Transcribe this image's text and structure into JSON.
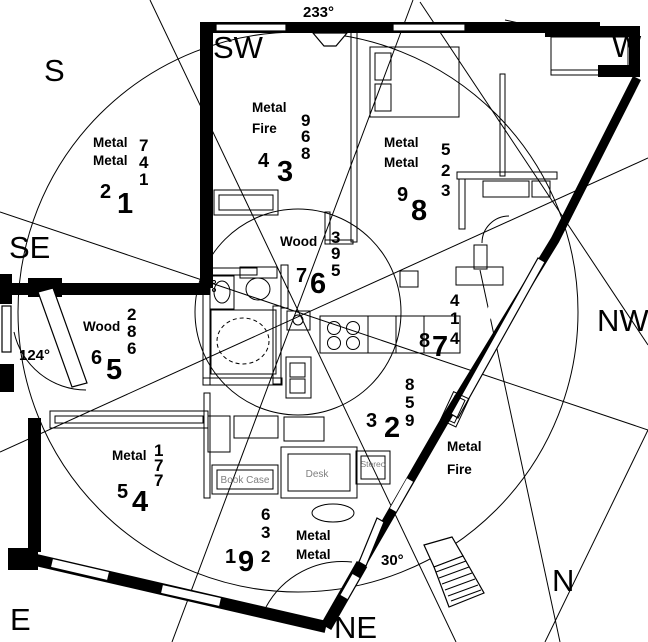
{
  "compass": {
    "s": "S",
    "sw": "SW",
    "w": "W",
    "nw": "NW",
    "n": "N",
    "ne": "NE",
    "e": "E",
    "se": "SE"
  },
  "angles": {
    "top": "233°",
    "left": "124°",
    "bottom": "30°"
  },
  "stars": {
    "s": {
      "el1": "Metal",
      "el2": "Metal",
      "left": "2",
      "main": "1",
      "col": [
        "7",
        "4",
        "1"
      ]
    },
    "sw": {
      "el1": "Metal",
      "el2": "Fire",
      "left": "4",
      "main": "3",
      "col": [
        "9",
        "6",
        "8"
      ]
    },
    "w": {
      "el1": "Metal",
      "el2": "Metal",
      "left": "9",
      "main": "8",
      "col": [
        "5",
        "2",
        "3"
      ]
    },
    "center": {
      "el1": "Wood",
      "left": "7",
      "main": "6",
      "col": [
        "3",
        "9",
        "5"
      ]
    },
    "se": {
      "el1": "Wood",
      "left": "6",
      "main": "5",
      "col": [
        "2",
        "8",
        "6"
      ]
    },
    "nw": {
      "left": "8",
      "main": "7",
      "col": [
        "4",
        "1",
        "4"
      ]
    },
    "n": {
      "el1": "Metal",
      "el2": "Fire",
      "left": "3",
      "main": "2",
      "col": [
        "8",
        "5",
        "9"
      ]
    },
    "e": {
      "el1": "Metal",
      "left": "5",
      "main": "4",
      "col": [
        "1",
        "7",
        "7"
      ]
    },
    "ne": {
      "el1": "Metal",
      "el2": "Metal",
      "left": "1",
      "main": "9",
      "col": [
        "6",
        "3",
        "2"
      ]
    }
  },
  "furniture": {
    "book_case": "Book Case",
    "desk": "Desk",
    "stereo": "Stereo"
  }
}
